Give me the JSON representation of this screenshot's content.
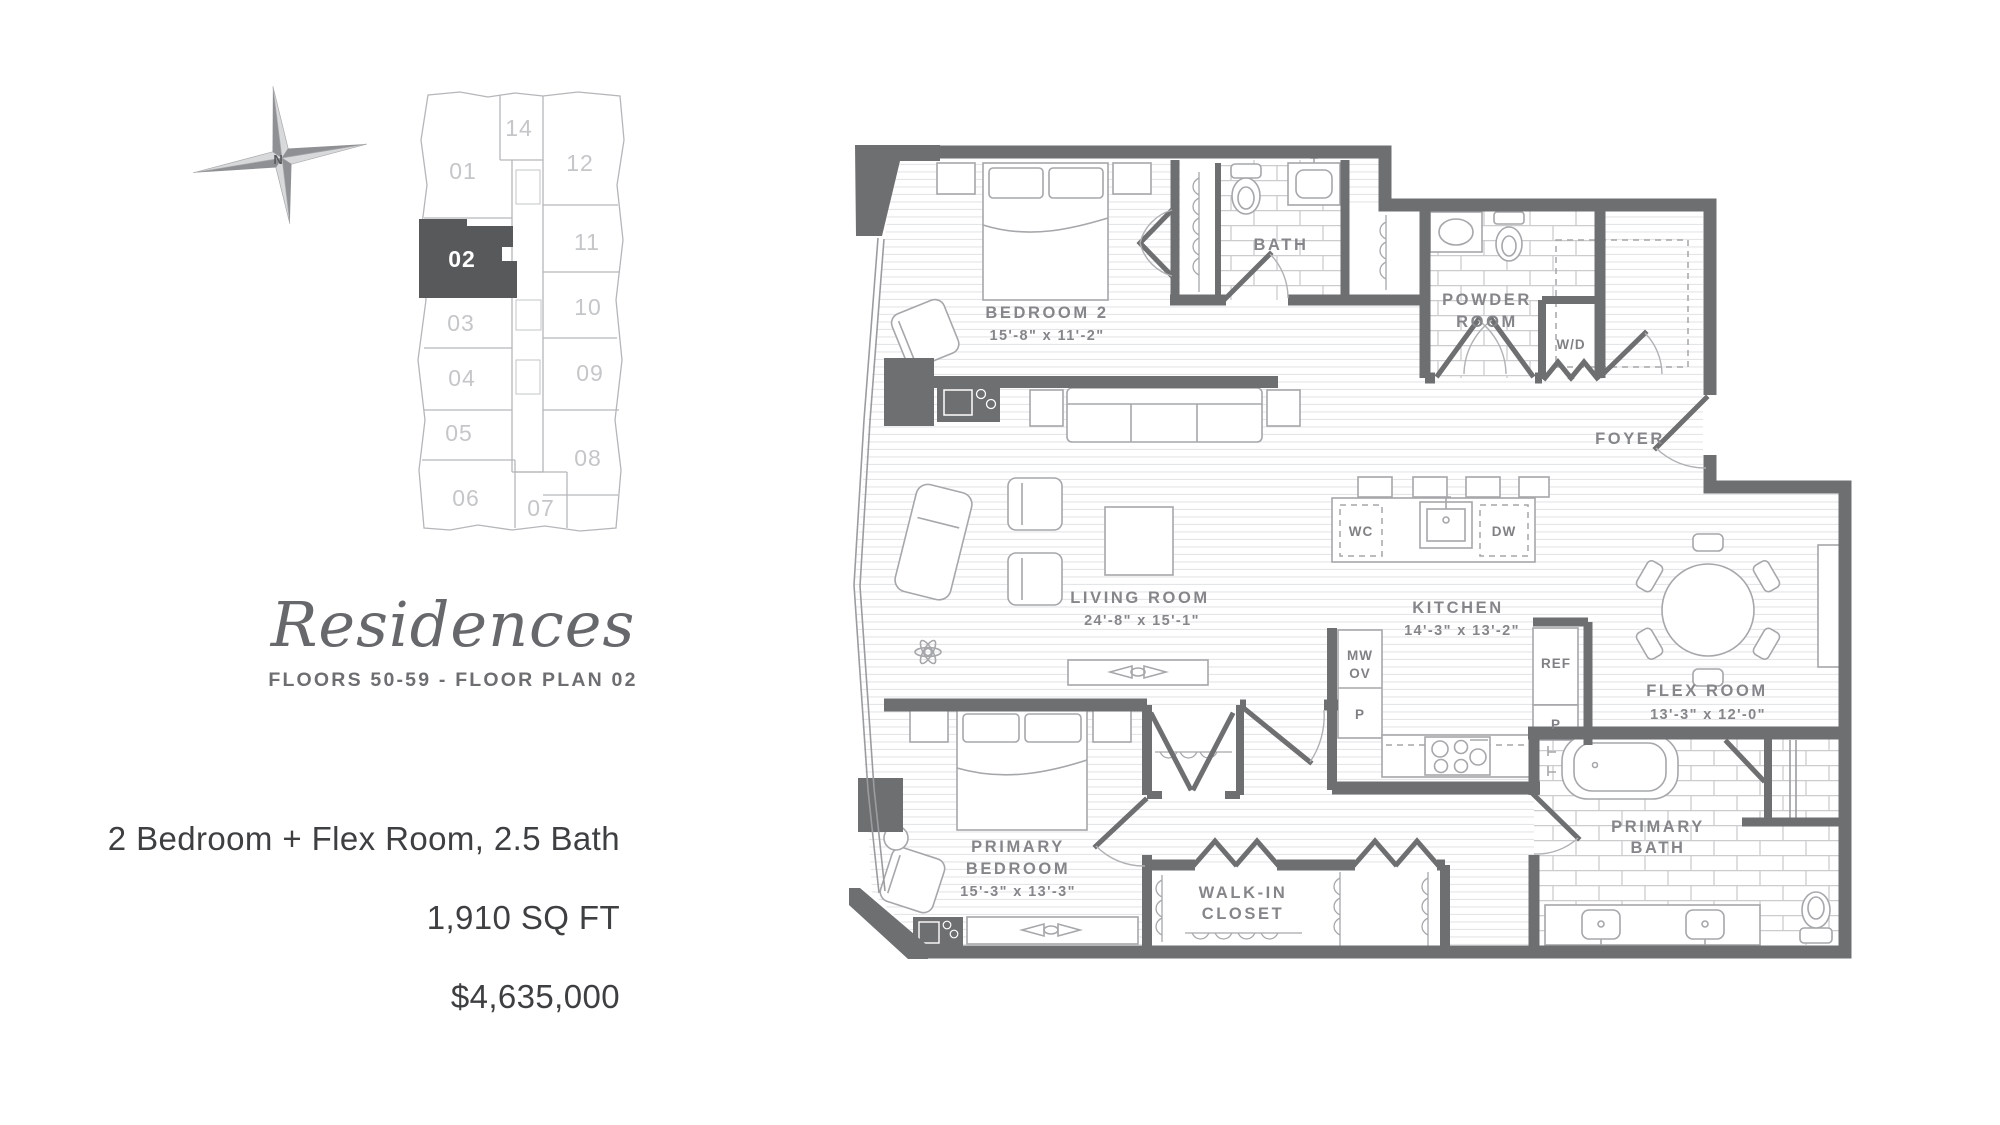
{
  "compass": {
    "label": "N"
  },
  "keyplan": {
    "highlighted_unit": "02",
    "highlight_color": "#58595b",
    "units": {
      "u01": "01",
      "u02": "02",
      "u03": "03",
      "u04": "04",
      "u05": "05",
      "u06": "06",
      "u07": "07",
      "u08": "08",
      "u09": "09",
      "u10": "10",
      "u11": "11",
      "u12": "12",
      "u14": "14"
    }
  },
  "title": {
    "name": "Residences",
    "subtitle": "FLOORS 50-59 - FLOOR PLAN 02"
  },
  "specs": {
    "configuration": "2 Bedroom + Flex Room, 2.5 Bath",
    "area": "1,910 SQ FT",
    "price": "$4,635,000"
  },
  "floorplan": {
    "wall_color": "#6e6f71",
    "labels": {
      "bedroom2": "BEDROOM 2",
      "bedroom2_dims": "15'-8\" x 11'-2\"",
      "bath": "BATH",
      "powder_line1": "POWDER",
      "powder_line2": "ROOM",
      "wd": "W/D",
      "foyer": "FOYER",
      "living": "LIVING ROOM",
      "living_dims": "24'-8\" x 15'-1\"",
      "kitchen": "KITCHEN",
      "kitchen_dims": "14'-3\" x 13'-2\"",
      "flex": "FLEX ROOM",
      "flex_dims": "13'-3\" x 12'-0\"",
      "primary_line1": "PRIMARY",
      "primary_line2": "BEDROOM",
      "primary_dims": "15'-3\" x 13'-3\"",
      "wic_line1": "WALK-IN",
      "wic_line2": "CLOSET",
      "pbath_line1": "PRIMARY",
      "pbath_line2": "BATH",
      "wc": "WC",
      "dw": "DW",
      "mw": "MW",
      "ov": "OV",
      "p_upper": "P",
      "ref": "REF",
      "p_lower": "P"
    }
  }
}
